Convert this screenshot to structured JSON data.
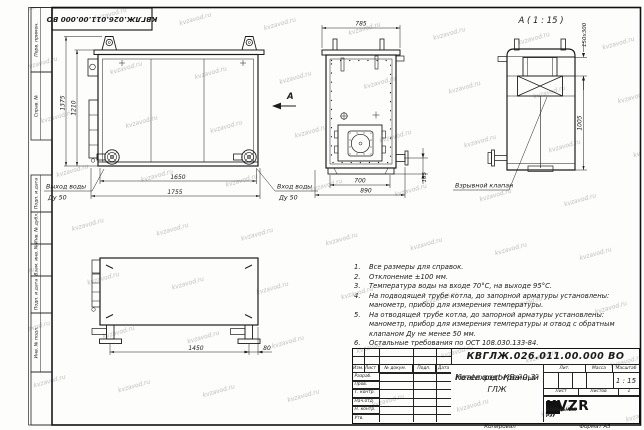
{
  "sheet": {
    "watermark": "kvzavod.ru",
    "copied_label": "Копировал",
    "format_label": "Формат А3"
  },
  "stamp_column": {
    "perv_primen": "Перв. примен.",
    "sprav_no": "Справ. №",
    "podp_data_1": "Подп. и дата",
    "inv_dubl": "Инв. № дубл.",
    "vzam_inv": "Взам. инв. №",
    "podp_data_2": "Подп. и дата",
    "inv_podl": "Инв. № подл."
  },
  "views": {
    "front": {
      "dim_height_outer": "1375",
      "dim_height_inner": "1210",
      "dim_width_inner": "1650",
      "dim_width_outer": "1755",
      "outlet_label": "Выход воды",
      "outlet_dn": "Ду 50",
      "inlet_label": "Вход воды",
      "inlet_dn": "Ду 50",
      "section_arrow_label": "А"
    },
    "side": {
      "dim_top": "785",
      "dim_bottom_inner": "700",
      "dim_bottom_outer": "890",
      "dim_pipe_height": "165"
    },
    "back": {
      "view_title": "А ( 1 : 15 )",
      "dim_chimney": "150х300",
      "dim_height": "1005",
      "valve_label": "Взрывной клапан"
    },
    "top": {
      "dim_length": "1450",
      "dim_offset": "80"
    }
  },
  "notes": {
    "items": [
      {
        "num": "1.",
        "text": "Все размеры для справок."
      },
      {
        "num": "2.",
        "text": "Отклонение ±100 мм."
      },
      {
        "num": "3.",
        "text": "Температура воды на входе 70°С, на выходе 95°С."
      },
      {
        "num": "4.",
        "text": "На подводящей трубе котла, до запорной арматуры установлены: манометр, прибор для измерения температуры."
      },
      {
        "num": "5.",
        "text": "На отводящей трубе котла, до запорной арматуры установлены: манометр, прибор для измерения температуры и отвод с обратным клапаном Ду не менее 50 мм."
      },
      {
        "num": "6.",
        "text": "Остальные требования по ОСТ 108.030.133-84."
      }
    ]
  },
  "title_block": {
    "doc_number": "КВГЛЖ.026.011.00.000 ВО",
    "product_name_line1": "Котел водогрейный",
    "product_name_line2": "Heatexpert-КВа-0,3-ГЛЖ",
    "col_izm": "Изм.",
    "col_list": "Лист",
    "col_docum": "№ докум.",
    "col_podp": "Подп.",
    "col_data": "Дата",
    "rows": [
      "Разраб.",
      "Пров.",
      "Т. контр.",
      "Нач.отд.",
      "Н. контр.",
      "Утв."
    ],
    "lit_label": "Лит.",
    "mass_label": "Масса",
    "scale_label": "Масштаб",
    "scale_value": "1 : 15",
    "sheet_label": "Лист",
    "sheets_label": "Листов",
    "sheets_value": "1",
    "logo_text": "KVZR",
    "company_line1": "КОТЕЛЬНЫЙ",
    "company_line2": "ЗАВОД РЭУ"
  }
}
